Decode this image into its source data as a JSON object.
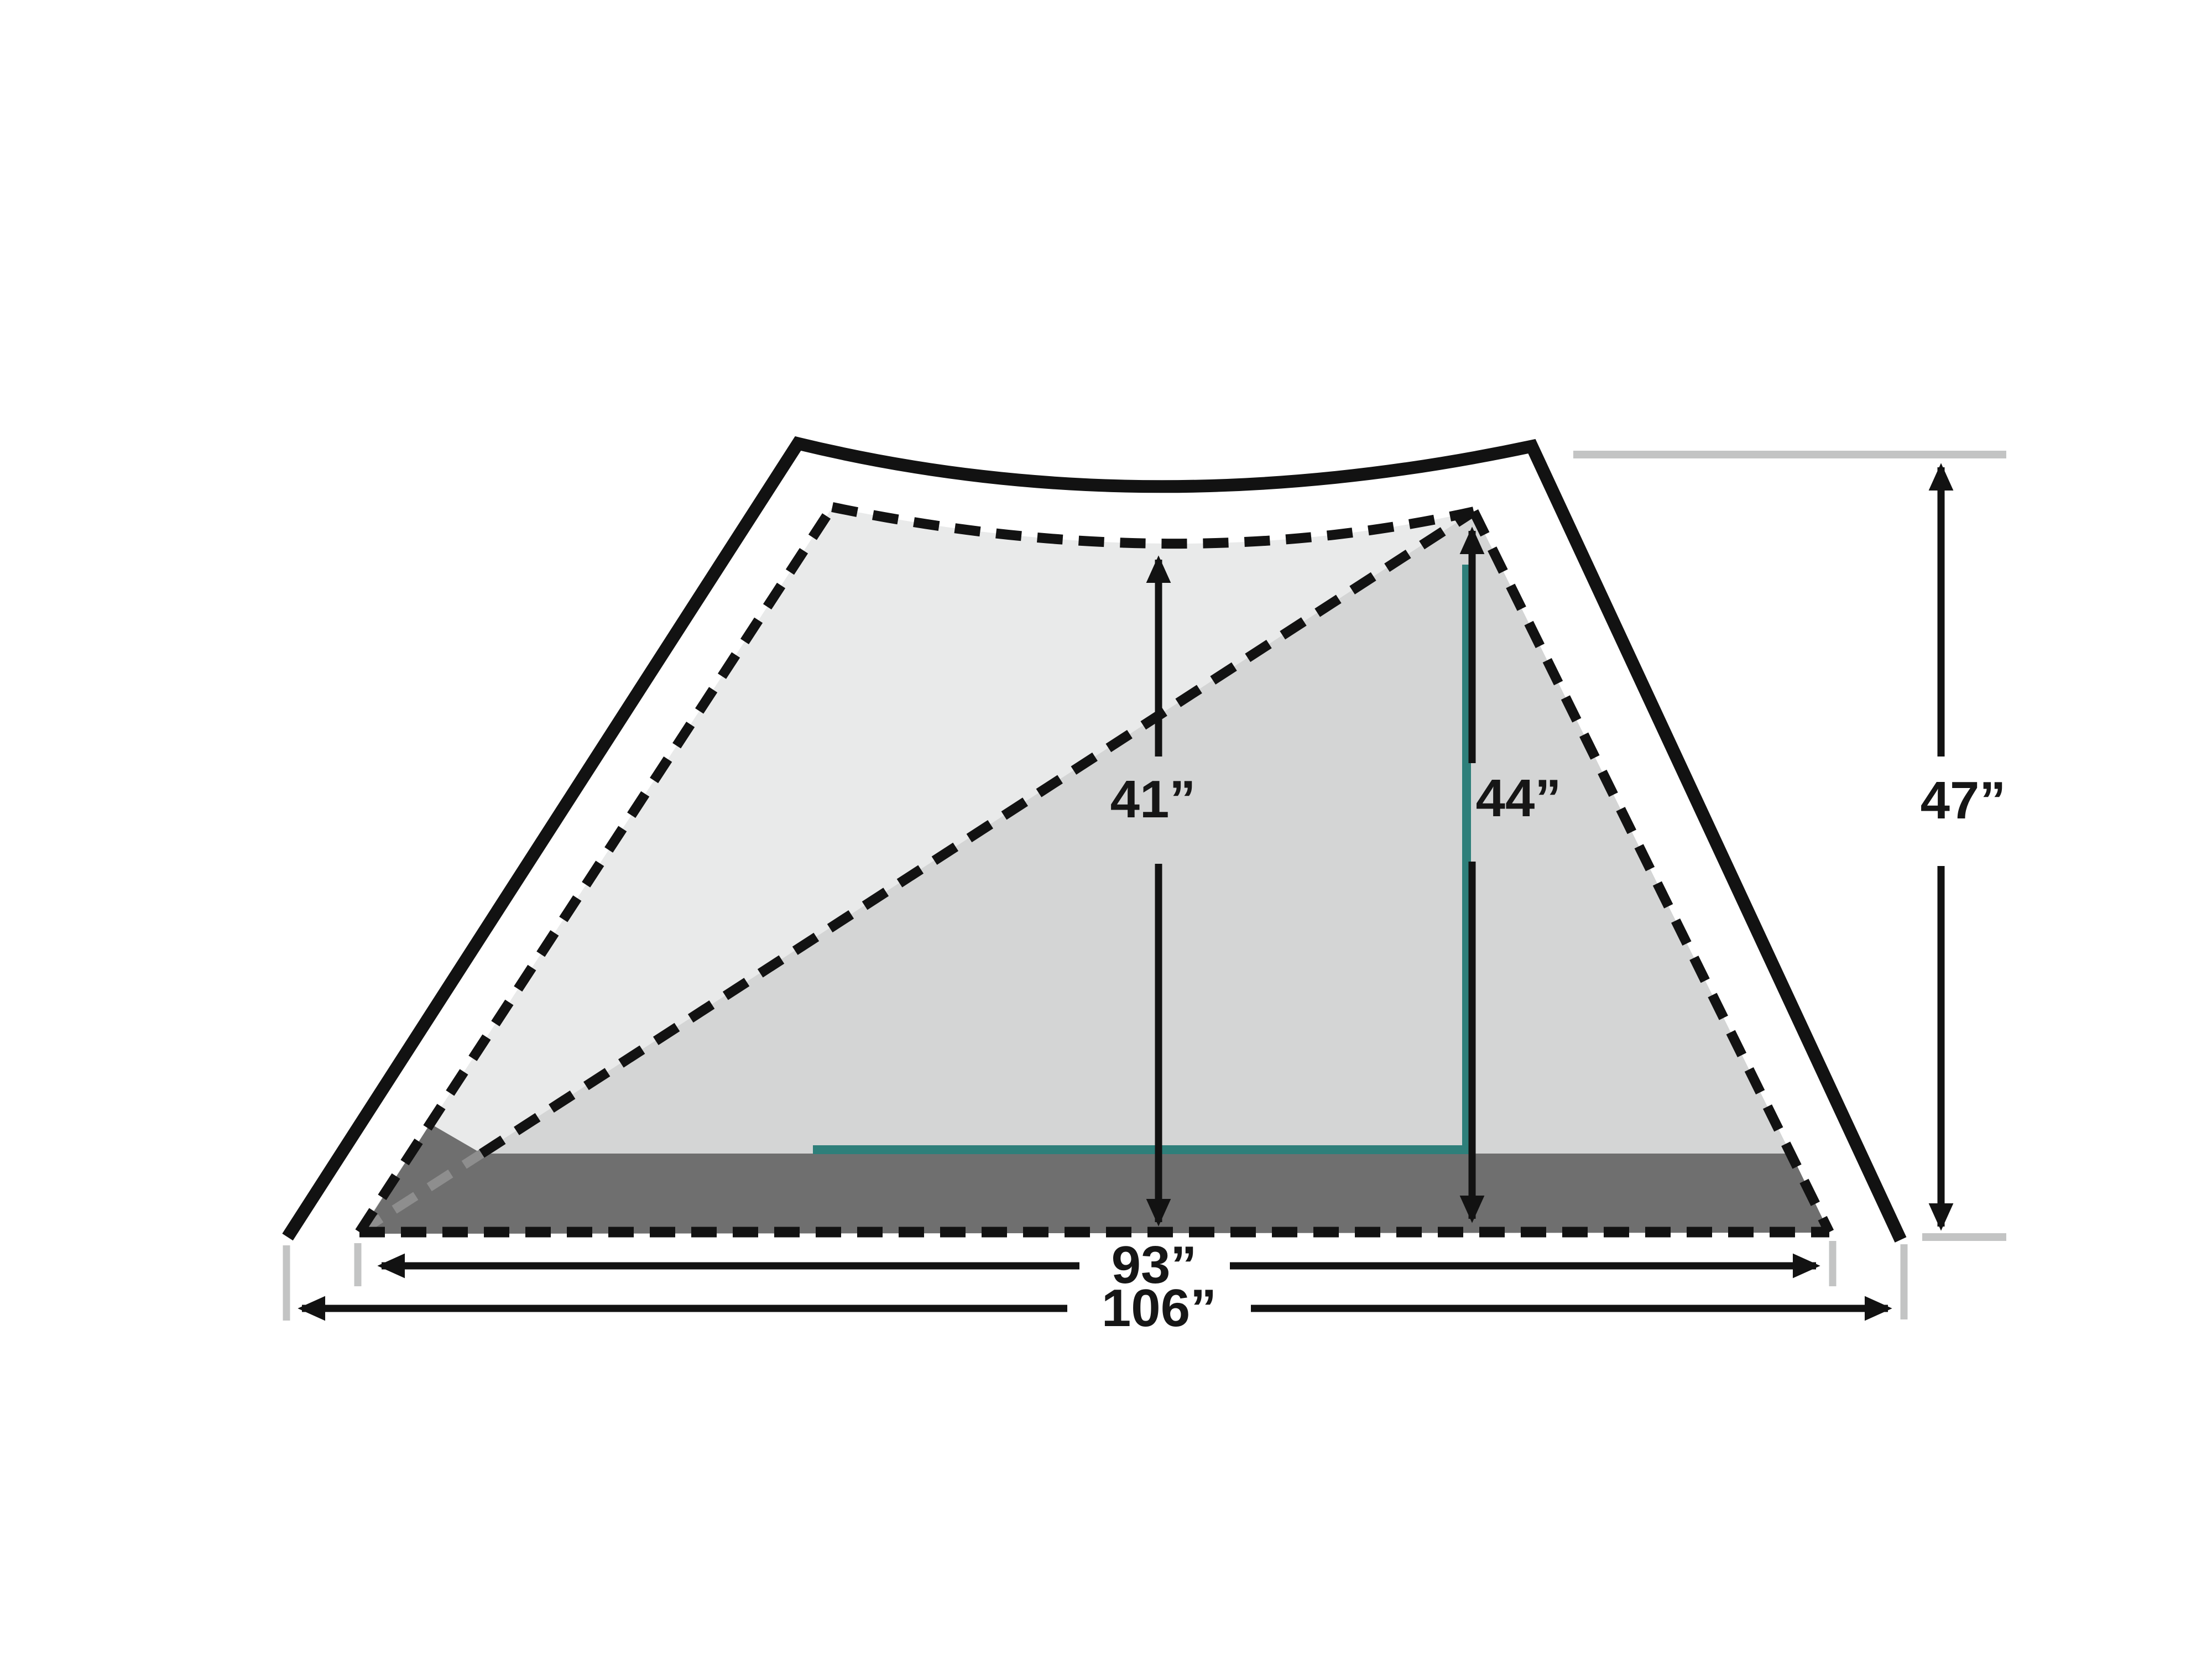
{
  "diagram": {
    "subject": "tent-cross-section-dimension-diagram",
    "unit": "inches",
    "labels": {
      "interior_height": "41”",
      "peak_height": "44”",
      "overall_height": "47”",
      "floor_length": "93”",
      "overall_length": "106”"
    },
    "values": {
      "interior_height": 41,
      "peak_height": 44,
      "overall_height": 47,
      "floor_length": 93,
      "overall_length": 106
    },
    "colors": {
      "ink": "#121212",
      "panel_light": "#e9eaea",
      "panel_shaded": "#d4d5d5",
      "floor": "#6f6f6f",
      "floor_dash_overlay": "#8e8e8e",
      "pole_teal": "#2e7f7a",
      "reference_gray": "#c3c4c4",
      "label_text": "#161616",
      "background": "#ffffff"
    }
  }
}
